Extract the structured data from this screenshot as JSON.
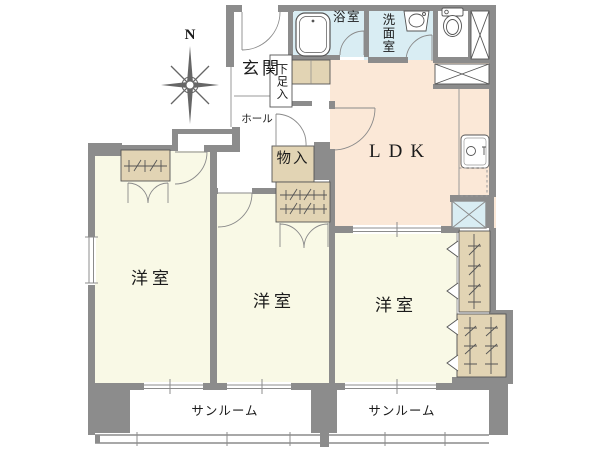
{
  "plan": {
    "compass": {
      "north": "N"
    },
    "rooms": {
      "entrance": {
        "label": "玄関"
      },
      "shoe_cabinet": {
        "label": "下足入"
      },
      "bath": {
        "label": "浴室"
      },
      "washroom": {
        "label": "洗面室"
      },
      "hall": {
        "label": "ホール"
      },
      "storage": {
        "label": "物入"
      },
      "ldk": {
        "label": "LDK"
      },
      "bedroom_left": {
        "label": "洋室"
      },
      "bedroom_middle": {
        "label": "洋室"
      },
      "bedroom_right": {
        "label": "洋室"
      },
      "sunroom_left": {
        "label": "サンルーム"
      },
      "sunroom_right": {
        "label": "サンルーム"
      }
    },
    "icons": {
      "compass": "compass-rose-icon",
      "bathtub": "bathtub-icon",
      "washbasin": "washbasin-icon",
      "toilet": "toilet-icon",
      "kitchen_sink": "kitchen-sink-icon",
      "washer_space": "washing-machine-space-icon",
      "refrigerator_space": "refrigerator-space-icon"
    },
    "colors": {
      "wall": "#8c8c8c",
      "room": "#f9f9e6",
      "ldk": "#fbe8d7",
      "wet_area": "#d9edf3",
      "closet": "#e2d4b4"
    }
  }
}
